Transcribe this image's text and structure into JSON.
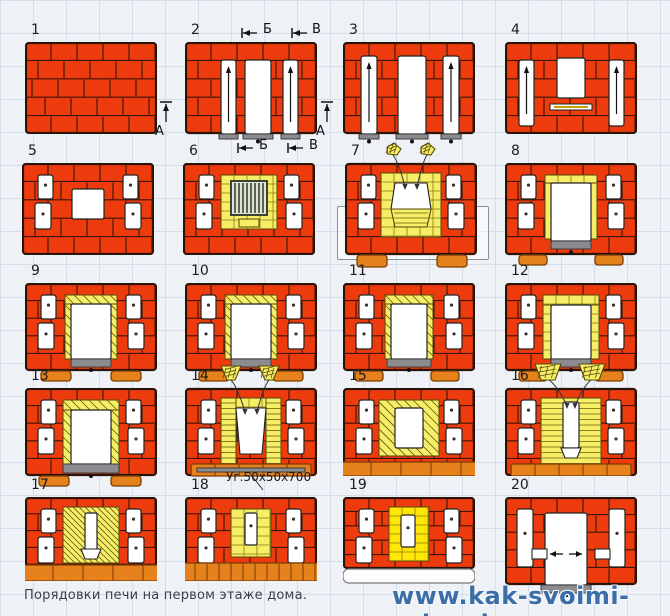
{
  "page": {
    "background": "#eef2f6",
    "grid_color": "#d2dfeb",
    "grid_size_px": 33
  },
  "colors": {
    "brick": "#ee3b0e",
    "brick_joint": "#3a1505",
    "outline": "#2a1205",
    "orange": "#e5821c",
    "orange_edge": "#7a3c05",
    "yellow": "#f6ee67",
    "yellow_edge": "#56470a",
    "yellow_bright": "#ffe607",
    "white": "#ffffff",
    "channel_edge": "#222222",
    "gray_bar": "#8c8c90",
    "gray_bar_edge": "#3c3c3c",
    "grate_fill": "#dfe3d5",
    "grate_edge": "#39452f",
    "watermark_blue": "#3b6da8",
    "caption_text": "#3a3f4c"
  },
  "tiles": [
    {
      "number": "1"
    },
    {
      "number": "2"
    },
    {
      "number": "3"
    },
    {
      "number": "4"
    },
    {
      "number": "5"
    },
    {
      "number": "6"
    },
    {
      "number": "7"
    },
    {
      "number": "8"
    },
    {
      "number": "9"
    },
    {
      "number": "10"
    },
    {
      "number": "11"
    },
    {
      "number": "12"
    },
    {
      "number": "13"
    },
    {
      "number": "14"
    },
    {
      "number": "15"
    },
    {
      "number": "16"
    },
    {
      "number": "17"
    },
    {
      "number": "18"
    },
    {
      "number": "19"
    },
    {
      "number": "20"
    }
  ],
  "section_marks": {
    "a": "А",
    "b": "Б",
    "v": "В"
  },
  "annotations": {
    "angle_label": "Уг.50x50x700"
  },
  "caption": "Порядовки печи на первом этаже дома.",
  "watermark": "www.kak-svoimi-rukami.com"
}
